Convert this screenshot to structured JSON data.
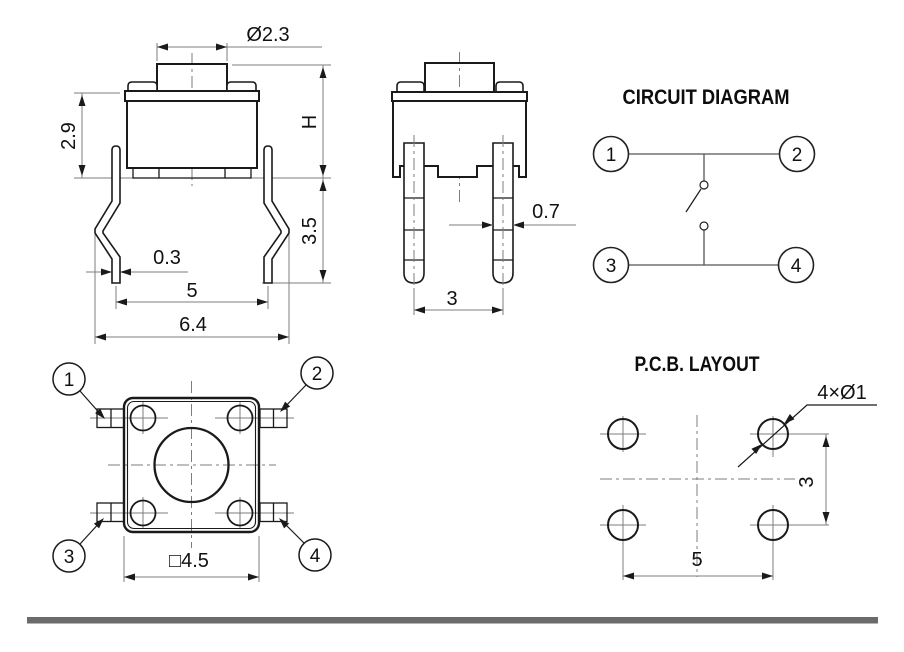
{
  "front_view": {
    "labels": {
      "button_dia": "Ø2.3",
      "upper_height": "2.9",
      "total_height": "H",
      "lead_height": "3.5",
      "lead_thickness": "0.3",
      "lead_pitch": "5",
      "lead_span": "6.4"
    }
  },
  "side_view": {
    "labels": {
      "pin_width": "0.7",
      "pin_pitch": "3"
    }
  },
  "circuit_diagram": {
    "title": "CIRCUIT DIAGRAM",
    "terminals": [
      "1",
      "2",
      "3",
      "4"
    ]
  },
  "top_view": {
    "terminals": [
      "1",
      "2",
      "3",
      "4"
    ],
    "labels": {
      "body_size": "□4.5"
    }
  },
  "pcb_layout": {
    "title": "P.C.B. LAYOUT",
    "labels": {
      "holes": "4×Ø1",
      "pitch_v": "3",
      "pitch_h": "5"
    }
  },
  "colors": {
    "line": "#1a1a1a",
    "dim_line": "#7d7d7d",
    "footer_bar": "#6b6b6b"
  }
}
